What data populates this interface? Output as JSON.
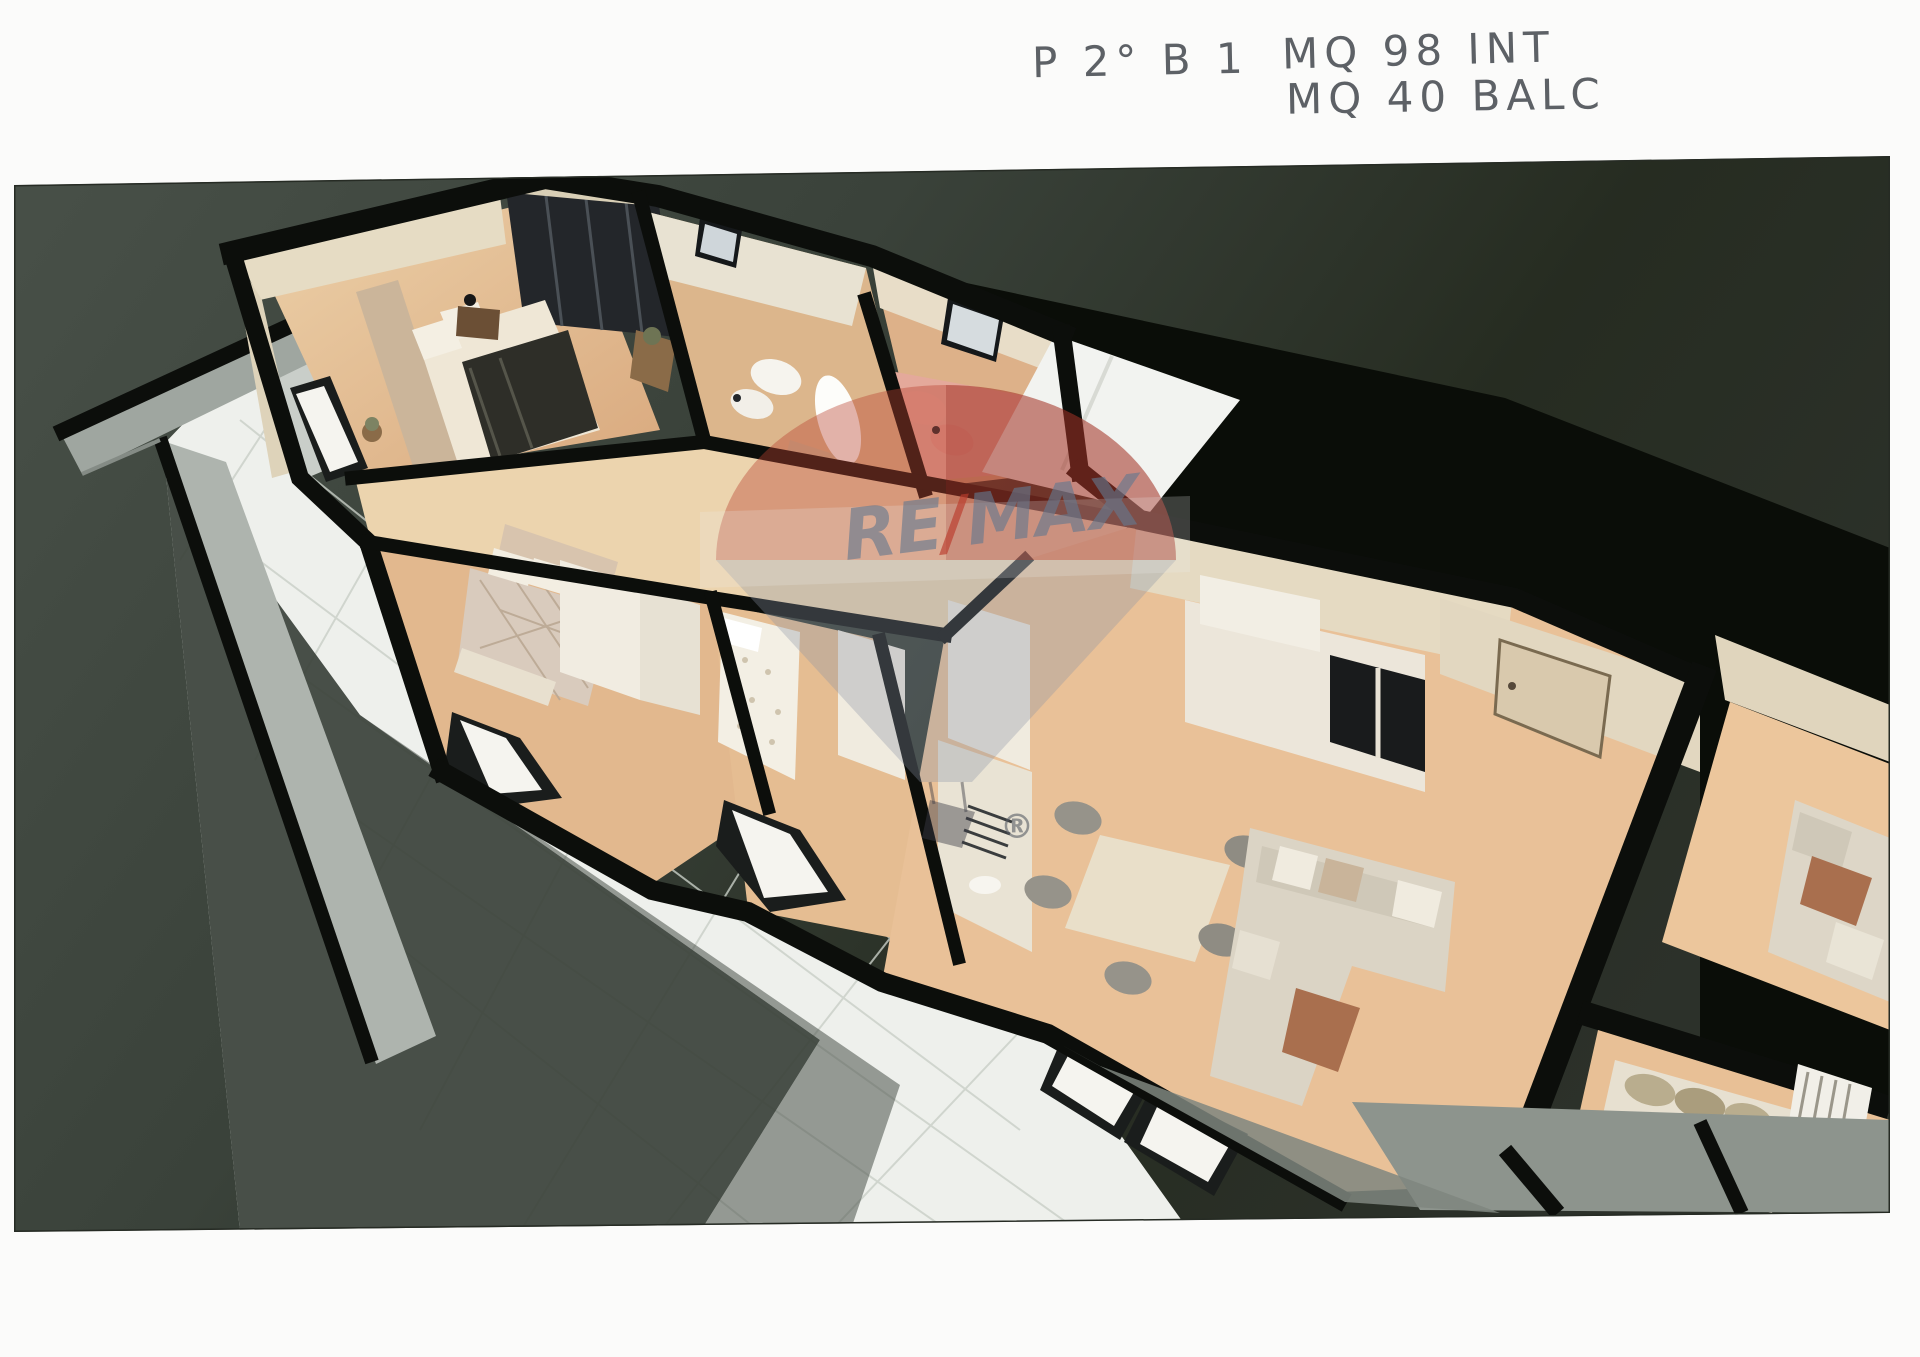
{
  "annotation": {
    "plan_code": "P 2° B 1",
    "line1": "MQ 98 INT",
    "line2": "MQ 40 BALC",
    "pencil_color": "#5d6166"
  },
  "watermark": {
    "part_re": "RE",
    "part_slash": "/",
    "part_max": "MAX",
    "registered": "®",
    "red": "#b8422f",
    "blue": "#69788f"
  },
  "palette": {
    "page_background": "#fbfbfa",
    "ground_olive": "#3f473f",
    "ground_dark": "#11150e",
    "wall_black": "#0c0e0b",
    "wall_beige": "#e6dcc4",
    "floor_wood": "#dfb58b",
    "floor_wood_light": "#ecd4ae",
    "terrace_tile": "#eef0ec",
    "balcony_grey": "#a3aaa3",
    "bath_pink": "#e4a99b",
    "sofa_cream": "#dbd4c5",
    "blanket_dark": "#2e2e28"
  },
  "scene": {
    "regions": [
      "master-bedroom",
      "bathroom-white",
      "bathroom-pink",
      "bedroom-2",
      "bedroom-3",
      "corridor",
      "kitchen",
      "living-room",
      "entrance",
      "terrace",
      "balcony",
      "stairwell-landing",
      "adjacent-apartment",
      "skylight"
    ]
  }
}
